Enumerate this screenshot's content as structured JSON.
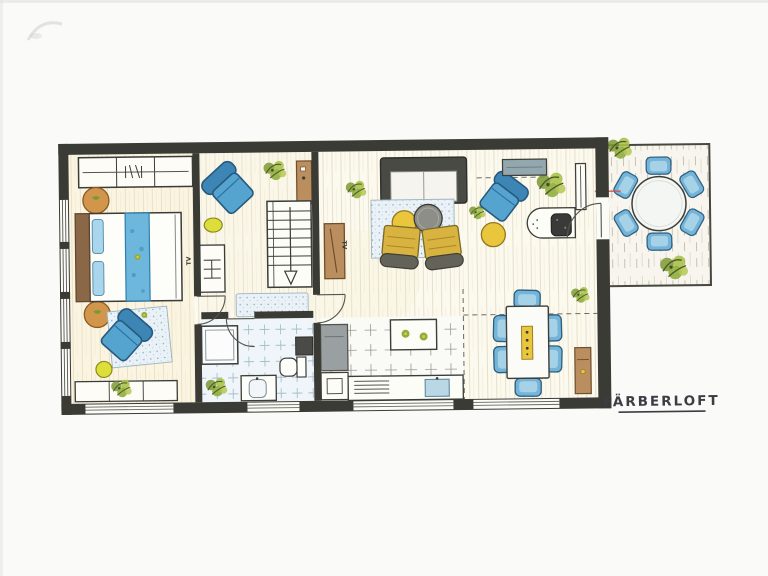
{
  "title": "FÄRBERLOFT",
  "labels": {
    "bedroom_tv": "TV",
    "living_tv": "TV"
  },
  "palette": {
    "wall": "#3b3b35",
    "ink": "#3c3c44",
    "wood": "#bb8e5f",
    "wood_dark": "#9a6f42",
    "headboard": "#8a6847",
    "runner_blue": "#6db6dc",
    "pillow_blue": "#a9d6ec",
    "chair_blue": "#55a3cf",
    "chair_blue_dark": "#3d85b5",
    "dining_chair": "#74b4d8",
    "yellow": "#e9c63b",
    "yellow_green": "#dede3a",
    "olive_seat": "#d9b33f",
    "olive_back": "#63635a",
    "tan": "#d1964b",
    "plant_green": "#8fae3e",
    "bench_gray": "#93a7ae",
    "table_gray": "#8e8e88",
    "sink_blue": "#b9d7e5",
    "unit_gray": "#9aa0a2",
    "red_mark": "#d14b4b"
  },
  "rooms": {
    "bedroom": {
      "name": "bedroom",
      "furniture": [
        "wardrobe with rail",
        "double bed with blue runner",
        "two tan bedside poufs",
        "blue armchair on speckled rug",
        "yellow pouf",
        "low sideboard",
        "wall TV",
        "plant"
      ]
    },
    "hall": {
      "name": "hall-dressing",
      "furniture": [
        "blue armchair",
        "yellow pouf",
        "wood console",
        "shelf with rail",
        "staircase down",
        "runner rug"
      ]
    },
    "bathroom": {
      "name": "bathroom",
      "furniture": [
        "shower",
        "washer unit",
        "toilet",
        "washbasin",
        "plant"
      ]
    },
    "living": {
      "name": "living-room",
      "furniture": [
        "sofa",
        "speckled rug",
        "round coffee tables yellow+gray",
        "two olive armchairs",
        "wood TV lowboard",
        "blue armchair",
        "yellow pouf",
        "desk with chair",
        "gray bench",
        "radiator",
        "plants"
      ]
    },
    "kitchen": {
      "name": "kitchen",
      "furniture": [
        "tall gray unit",
        "island with two bowls",
        "cooktop",
        "blue sink",
        "base cabinet"
      ]
    },
    "dining": {
      "name": "dining-area",
      "furniture": [
        "rectangular table",
        "six blue chairs",
        "yellow runner with candles",
        "wood console",
        "plant"
      ]
    },
    "terrace": {
      "name": "terrace",
      "furniture": [
        "round table",
        "six blue chairs",
        "two plants"
      ]
    }
  }
}
